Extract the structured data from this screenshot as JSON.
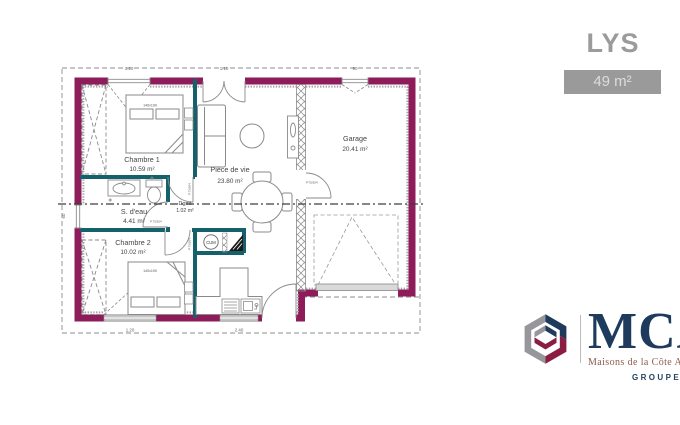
{
  "title": "LYS",
  "area_badge": "49 m²",
  "rooms": {
    "chambre1": {
      "name": "Chambre 1",
      "area": "10.59 m²"
    },
    "sdeau": {
      "name": "S. d'eau",
      "area": "4.41 m²"
    },
    "dgmt": {
      "name": "Dgmt",
      "area": "1.02 m²"
    },
    "chambre2": {
      "name": "Chambre 2",
      "area": "10.02 m²"
    },
    "piece_de_vie": {
      "name": "Pièce de vie",
      "area": "23.80 m²"
    },
    "garage": {
      "name": "Garage",
      "area": "20.41 m²"
    }
  },
  "annotations": {
    "bed1_size": "140x190",
    "bed2_size": "140x190",
    "water_heater": "CUM",
    "door_interior": "P.73/204",
    "door_garage": "P.75/204"
  },
  "dims": {
    "top_window": "1.20",
    "entrance": "1.10",
    "garage_window": "90",
    "bottom_window": "1.20",
    "kitchen_window": "2.40",
    "left_window": "60"
  },
  "logo": {
    "brand": "MCA",
    "subtitle": "Maisons de la Côte Atlantique",
    "group": "GROUPE HEXAOM"
  },
  "colors": {
    "wall": "#8E1C5B",
    "partition": "#15616B",
    "title_gray": "#9B9B9B",
    "navy": "#1E3B5E",
    "logo_red": "#8C1D42"
  }
}
